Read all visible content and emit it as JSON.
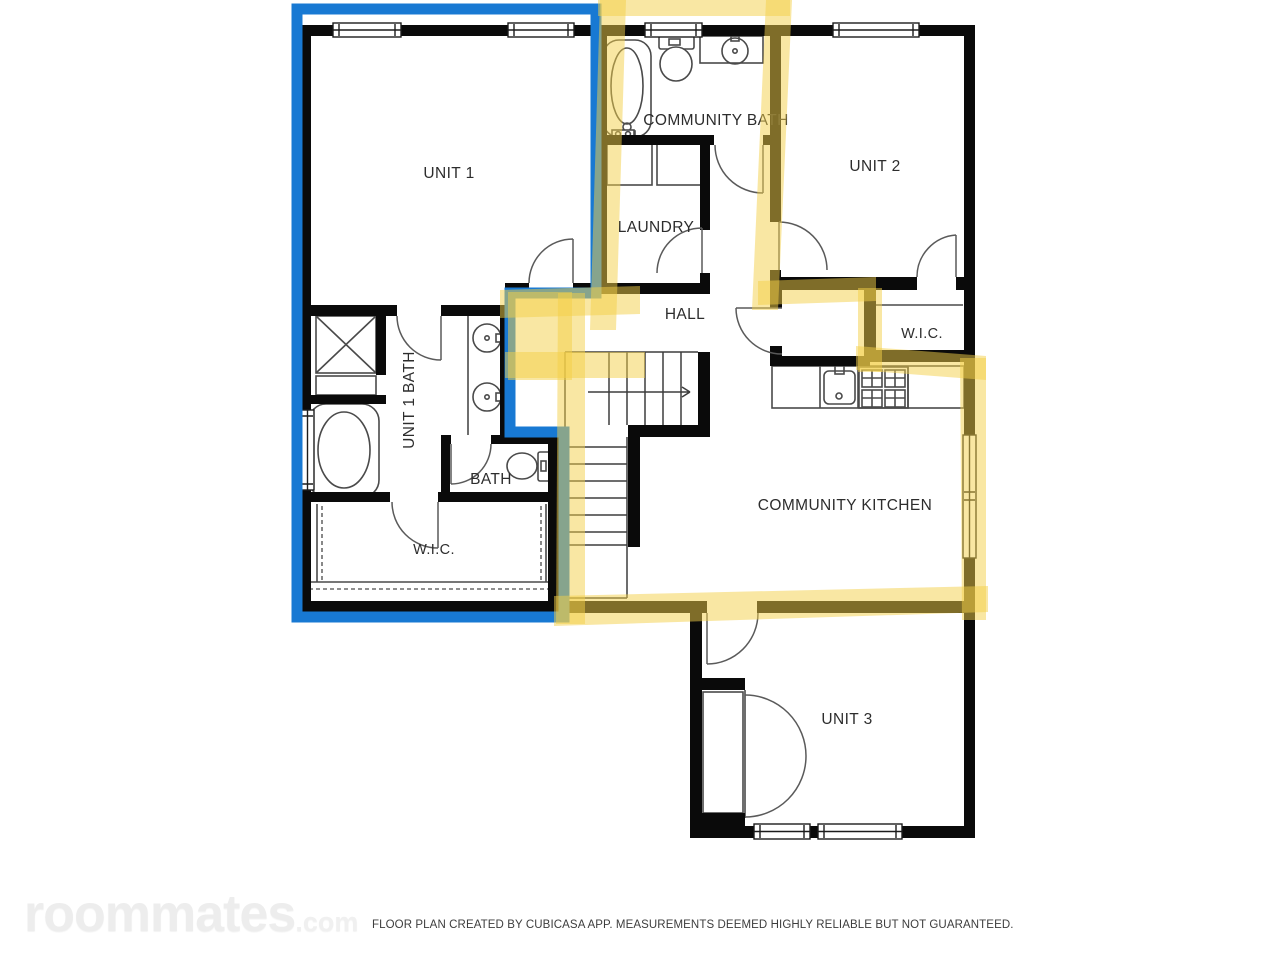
{
  "floor_plan": {
    "labels": {
      "unit1": "UNIT 1",
      "community_bath": "COMMUNITY BATH",
      "unit2": "UNIT 2",
      "laundry": "LAUNDRY",
      "hall": "HALL",
      "unit2_wic": "W.I.C.",
      "unit1_bath": "UNIT 1 BATH",
      "bath": "BATH",
      "unit1_wic": "W.I.C.",
      "community_kitchen": "COMMUNITY KITCHEN",
      "unit3": "UNIT 3"
    },
    "colors": {
      "walls": "#0a0a0a",
      "unit1_outline": "#1879d3",
      "communal_highlight": "#f3cf47"
    }
  },
  "watermark": {
    "brand": "roommates",
    "tld": ".com"
  },
  "footer": {
    "disclaimer": "FLOOR PLAN CREATED BY CUBICASA APP. MEASUREMENTS DEEMED HIGHLY RELIABLE BUT NOT GUARANTEED."
  }
}
